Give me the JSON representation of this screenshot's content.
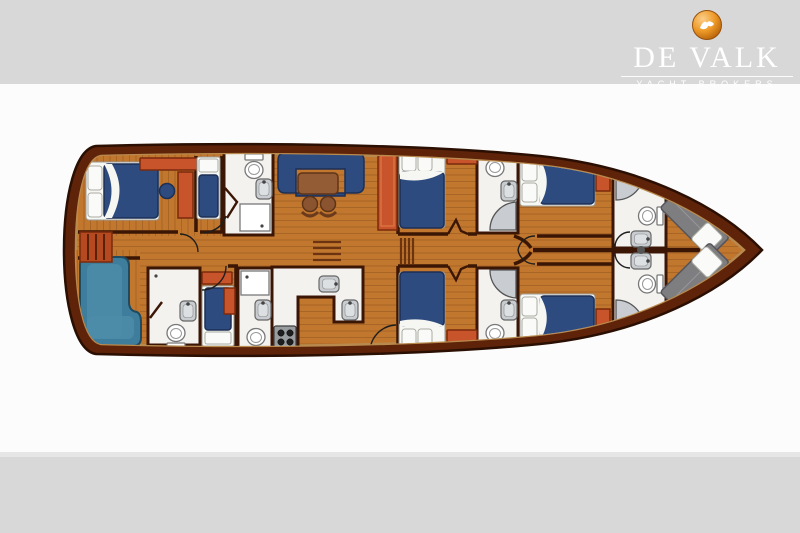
{
  "brand": {
    "title": "DE VALK",
    "subtitle": "YACHT BROKERS",
    "logo_icon": "falcon-sphere-icon"
  },
  "palette": {
    "bandGray": "#D8D8D8",
    "hull": "#5E2309",
    "hullLine": "#2A0F02",
    "deck": "#B98A4E",
    "floor": "#C1772E",
    "plank": "#92571F",
    "wall": "#3C1604",
    "bath": "#F3F2EF",
    "fixture": "#C9CDD1",
    "bed": "#2E4B80",
    "bedLine": "#1C2F55",
    "linen": "#F7F7F4",
    "cabinet": "#C8542B",
    "cabinetLine": "#7A2A0C",
    "sofa": "#3E7D9B",
    "sofaLine": "#1F4A60",
    "table": "#935C35",
    "stool": "#8B5431",
    "berth": "#7E7E80",
    "logoText": "#FFFFFF"
  },
  "diagram": {
    "type": "yacht-floor-plan",
    "orientation": "bow-right",
    "rooms": [
      {
        "id": "aft-double-cabin",
        "label": "aft double cabin"
      },
      {
        "id": "aft-single-cabin-top",
        "label": "aft single cabin"
      },
      {
        "id": "aft-single-cabin-bottom",
        "label": "aft single cabin"
      },
      {
        "id": "aft-l-sofa",
        "label": "L-shaped settee"
      },
      {
        "id": "salon",
        "label": "salon with U-settee, table and stools"
      },
      {
        "id": "galley",
        "label": "galley with twin sinks and stove"
      },
      {
        "id": "mid-cabin-top",
        "label": "mid double cabin"
      },
      {
        "id": "mid-cabin-bottom",
        "label": "mid double cabin"
      },
      {
        "id": "fwd-cabin-top",
        "label": "forward double cabin"
      },
      {
        "id": "fwd-cabin-bottom",
        "label": "forward double cabin"
      },
      {
        "id": "bow-v-berths",
        "label": "bow V-berth bunks"
      },
      {
        "id": "bathrooms",
        "label": "six bath/shower rooms"
      }
    ]
  }
}
